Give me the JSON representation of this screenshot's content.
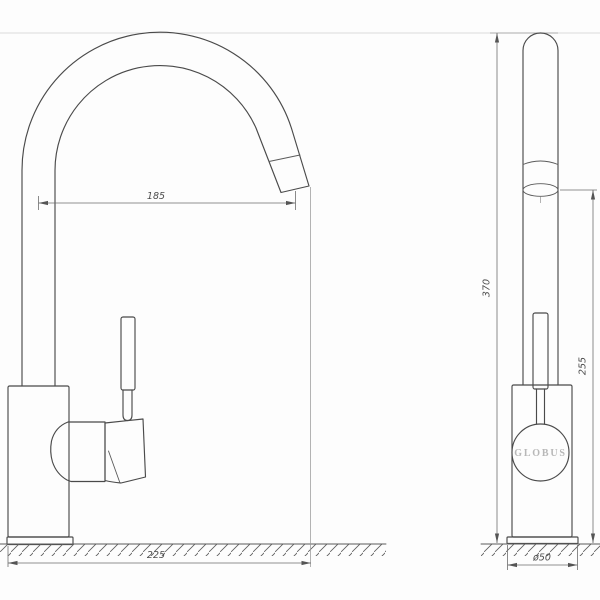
{
  "drawing": {
    "brand_logo": "GLOBUS",
    "dimensions": {
      "spout_reach": "185",
      "overall_depth": "225",
      "overall_height": "370",
      "outlet_height": "255",
      "base_diameter": "ø50"
    },
    "colors": {
      "outline": "#4a4a4a",
      "dimension_line": "#6e6e6e",
      "dimension_text": "#4d4d4d",
      "logo_text": "#b8b8b8",
      "background": "#fdfdfd"
    }
  }
}
